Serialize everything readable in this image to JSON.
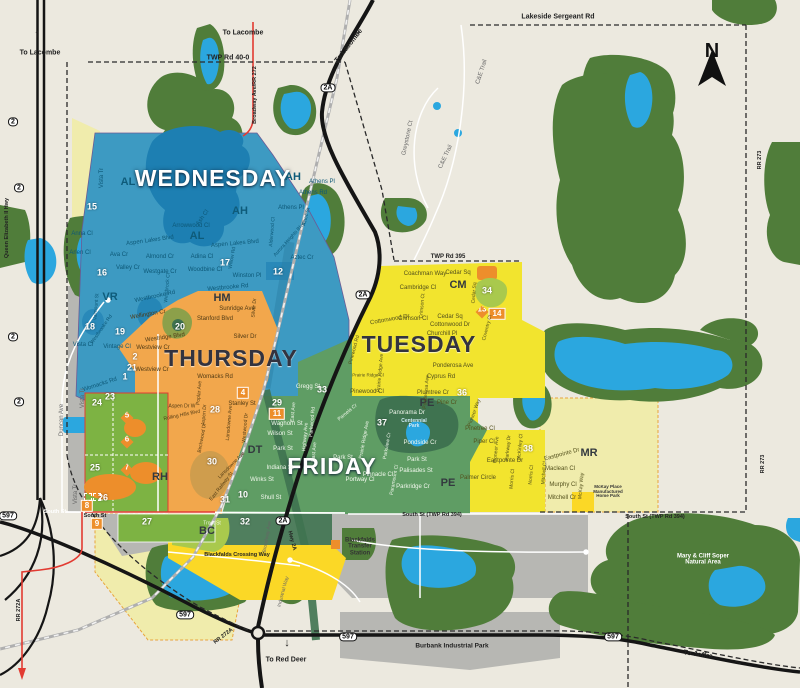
{
  "colors": {
    "background": "#ECE9DF",
    "forest": "#507D3A",
    "water": "#2BA7DF",
    "wednesday": "#3D9AC2",
    "thursday": "#F2A74C",
    "tuesday": "#F2E42E",
    "friday": "#5F9D64",
    "pale_zone": "#F0ECAC",
    "parcel_green": "#7DB343",
    "bc_gold": "#FBD826",
    "gray_zone": "#B7B7B3",
    "road": "#151515",
    "rail": "#AFAFAF",
    "route_red": "#E23B32",
    "marker_orange": "#ED8E2B",
    "dark_lake": "#1D7FB2",
    "park_olive": "#8CA04A",
    "dark_park": "#3F7350"
  },
  "compass": {
    "label": "N"
  },
  "days": [
    {
      "t": "WEDNESDAY",
      "x": 213,
      "y": 178,
      "c": "day-w",
      "n": "day-zone-label-wednesday"
    },
    {
      "t": "THURSDAY",
      "x": 231,
      "y": 358,
      "c": "day-d",
      "n": "day-zone-label-thursday"
    },
    {
      "t": "TUESDAY",
      "x": 419,
      "y": 344,
      "c": "day-d",
      "n": "day-zone-label-tuesday"
    },
    {
      "t": "FRIDAY",
      "x": 332,
      "y": 466,
      "c": "day-w",
      "n": "day-zone-label-friday"
    }
  ],
  "districts": [
    {
      "t": "AL",
      "x": 128,
      "y": 183,
      "c": "ac-b"
    },
    {
      "t": "AH",
      "x": 240,
      "y": 212,
      "c": "ac-b"
    },
    {
      "t": "AH",
      "x": 293,
      "y": 178,
      "c": "ac-b"
    },
    {
      "t": "AL",
      "x": 197,
      "y": 237,
      "c": "ac-b"
    },
    {
      "t": "VR",
      "x": 110,
      "y": 298,
      "c": "ac-b"
    },
    {
      "t": "HM",
      "x": 222,
      "y": 299,
      "c": "ac-d"
    },
    {
      "t": "CM",
      "x": 458,
      "y": 286,
      "c": "ac-d"
    },
    {
      "t": "PE",
      "x": 427,
      "y": 404,
      "c": "ac-d"
    },
    {
      "t": "PE",
      "x": 448,
      "y": 484,
      "c": "ac-d"
    },
    {
      "t": "DT",
      "x": 255,
      "y": 451,
      "c": "ac-d"
    },
    {
      "t": "RH",
      "x": 160,
      "y": 478,
      "c": "ac-d"
    },
    {
      "t": "BC",
      "x": 207,
      "y": 532,
      "c": "ac-d"
    },
    {
      "t": "MR",
      "x": 589,
      "y": 454,
      "c": "ac-d"
    }
  ],
  "zone_numbers": [
    {
      "t": "15",
      "x": 92,
      "y": 207
    },
    {
      "t": "16",
      "x": 102,
      "y": 273
    },
    {
      "t": "17",
      "x": 225,
      "y": 263
    },
    {
      "t": "12",
      "x": 278,
      "y": 272
    },
    {
      "t": "18",
      "x": 90,
      "y": 327
    },
    {
      "t": "19",
      "x": 120,
      "y": 332
    },
    {
      "t": "20",
      "x": 180,
      "y": 327
    },
    {
      "t": "2",
      "x": 135,
      "y": 357
    },
    {
      "t": "21",
      "x": 132,
      "y": 368
    },
    {
      "t": "1",
      "x": 125,
      "y": 377
    },
    {
      "t": "23",
      "x": 110,
      "y": 397
    },
    {
      "t": "24",
      "x": 97,
      "y": 403
    },
    {
      "t": "25",
      "x": 95,
      "y": 468
    },
    {
      "t": "26",
      "x": 103,
      "y": 498
    },
    {
      "t": "27",
      "x": 147,
      "y": 522
    },
    {
      "t": "28",
      "x": 215,
      "y": 410
    },
    {
      "t": "29",
      "x": 277,
      "y": 403
    },
    {
      "t": "30",
      "x": 212,
      "y": 462
    },
    {
      "t": "31",
      "x": 225,
      "y": 500
    },
    {
      "t": "32",
      "x": 245,
      "y": 522
    },
    {
      "t": "33",
      "x": 322,
      "y": 390
    },
    {
      "t": "10",
      "x": 243,
      "y": 495
    },
    {
      "t": "34",
      "x": 487,
      "y": 291
    },
    {
      "t": "36",
      "x": 462,
      "y": 393
    },
    {
      "t": "37",
      "x": 382,
      "y": 423
    },
    {
      "t": "38",
      "x": 528,
      "y": 449
    }
  ],
  "zone_badges": [
    {
      "t": "8",
      "x": 87,
      "y": 506
    },
    {
      "t": "9",
      "x": 97,
      "y": 524
    },
    {
      "t": "11",
      "x": 277,
      "y": 414
    },
    {
      "t": "4",
      "x": 243,
      "y": 393
    },
    {
      "t": "14",
      "x": 497,
      "y": 314
    }
  ],
  "zone_markers": [
    {
      "t": "5",
      "x": 127,
      "y": 418
    },
    {
      "t": "6",
      "x": 127,
      "y": 442
    },
    {
      "t": "7",
      "x": 127,
      "y": 470
    },
    {
      "t": "13",
      "x": 482,
      "y": 312
    }
  ],
  "highway_badges": [
    {
      "t": "2A",
      "x": 328,
      "y": 88
    },
    {
      "t": "2A",
      "x": 363,
      "y": 295
    },
    {
      "t": "2A",
      "x": 283,
      "y": 521
    },
    {
      "t": "597",
      "x": 8,
      "y": 516
    },
    {
      "t": "597",
      "x": 185,
      "y": 615
    },
    {
      "t": "597",
      "x": 348,
      "y": 637
    },
    {
      "t": "597",
      "x": 613,
      "y": 637
    },
    {
      "t": "2",
      "x": 13,
      "y": 122
    },
    {
      "t": "2",
      "x": 19,
      "y": 188
    },
    {
      "t": "2",
      "x": 13,
      "y": 337
    },
    {
      "t": "2",
      "x": 19,
      "y": 402
    }
  ],
  "road_labels": [
    {
      "t": "TWP Rd 40-0",
      "x": 228,
      "y": 58
    },
    {
      "t": "Lakeside Sergeant Rd",
      "x": 558,
      "y": 17
    },
    {
      "t": "Broadway Ave/RR 272",
      "x": 256,
      "y": 95,
      "r": -90,
      "s": 5.5
    },
    {
      "t": "RR 273",
      "x": 761,
      "y": 160,
      "r": -90,
      "s": 5.5
    },
    {
      "t": "RR 273",
      "x": 764,
      "y": 464,
      "r": -90,
      "s": 5.5
    },
    {
      "t": "TWP Rd 395",
      "x": 448,
      "y": 257,
      "s": 6
    },
    {
      "t": "Queen Elizabeth II Hwy",
      "x": 8,
      "y": 228,
      "r": -90,
      "s": 5.5
    },
    {
      "t": "South St",
      "x": 55,
      "y": 513,
      "c": "rd-w",
      "s": 5.5
    },
    {
      "t": "South St",
      "x": 95,
      "y": 517,
      "s": 5.5
    },
    {
      "t": "South St (TWP Rd 394)",
      "x": 432,
      "y": 516,
      "s": 5.5
    },
    {
      "t": "South St (TWP Rd 394)",
      "x": 655,
      "y": 518,
      "s": 5.5
    },
    {
      "t": "Hwy 2A",
      "x": 291,
      "y": 541,
      "r": 75,
      "s": 5.5
    },
    {
      "t": "RR 272A",
      "x": 224,
      "y": 637,
      "r": -38,
      "s": 5.5
    },
    {
      "t": "RR 272A",
      "x": 20,
      "y": 610,
      "r": -90,
      "s": 5.5
    },
    {
      "t": "Burbank Industrial Park",
      "x": 452,
      "y": 647,
      "s": 6.5
    },
    {
      "t": "Blackfalds Crossing Way",
      "x": 237,
      "y": 556,
      "s": 5.5
    }
  ],
  "direction_labels": [
    {
      "t": "To Lacombe",
      "x": 40,
      "y": 53
    },
    {
      "t": "To Lacombe",
      "x": 243,
      "y": 33
    },
    {
      "t": "To Lacombe",
      "x": 349,
      "y": 46,
      "r": -52
    },
    {
      "t": "To Red Deer",
      "x": 286,
      "y": 660
    },
    {
      "t": "To Joffre",
      "x": 698,
      "y": 655,
      "r": 8
    }
  ],
  "arrows": [
    {
      "t": "↑",
      "x": 37,
      "y": 35
    },
    {
      "t": "↓",
      "x": 287,
      "y": 644
    },
    {
      "t": "→",
      "x": 357,
      "y": 34,
      "r": -55
    },
    {
      "t": "→",
      "x": 738,
      "y": 662,
      "r": 25
    }
  ],
  "poi_labels": [
    {
      "t": "Mary & Cliff Soper\nNatural Area",
      "x": 703,
      "y": 560,
      "c": "poi-w",
      "w": 80
    },
    {
      "t": "Blackfalds\nTransfer\nStation",
      "x": 360,
      "y": 547,
      "w": 46
    },
    {
      "t": "Centennial\nPark",
      "x": 414,
      "y": 424,
      "c": "poi-b",
      "w": 44,
      "s": 5
    },
    {
      "t": "McKay Place\nManufactured\nHome Park",
      "x": 608,
      "y": 492,
      "s": 4.5,
      "w": 42
    }
  ],
  "street_labels": [
    {
      "t": "Vista Tr",
      "x": 102,
      "y": 178,
      "r": -90,
      "c": "st-b"
    },
    {
      "t": "Anna Cl",
      "x": 82,
      "y": 234,
      "c": "st-b"
    },
    {
      "t": "Arlen Cl",
      "x": 80,
      "y": 253,
      "c": "st-b"
    },
    {
      "t": "Ava Cr",
      "x": 119,
      "y": 255,
      "c": "st-b"
    },
    {
      "t": "Aspen Lakes Blvd",
      "x": 150,
      "y": 241,
      "r": -8,
      "c": "st-b"
    },
    {
      "t": "Aspen Lakes Blvd",
      "x": 235,
      "y": 244,
      "r": -5,
      "c": "st-b"
    },
    {
      "t": "Almond Cr",
      "x": 160,
      "y": 257,
      "c": "st-b"
    },
    {
      "t": "Valley Cr",
      "x": 128,
      "y": 268,
      "c": "st-b"
    },
    {
      "t": "Westgate Cr",
      "x": 160,
      "y": 272,
      "c": "st-b"
    },
    {
      "t": "Westbrock Cl",
      "x": 168,
      "y": 288,
      "r": -85,
      "c": "st-b",
      "s": 5
    },
    {
      "t": "Westbrooke Rd",
      "x": 155,
      "y": 297,
      "r": -12,
      "c": "st-b"
    },
    {
      "t": "Westbrooke Rd",
      "x": 228,
      "y": 288,
      "r": -5,
      "c": "st-b"
    },
    {
      "t": "Arrowwood Cl",
      "x": 191,
      "y": 226,
      "c": "st-b"
    },
    {
      "t": "Ash Cl",
      "x": 203,
      "y": 218,
      "r": -55,
      "c": "st-b"
    },
    {
      "t": "Adina Cl",
      "x": 202,
      "y": 257,
      "c": "st-b"
    },
    {
      "t": "Woodbine Cl",
      "x": 205,
      "y": 270,
      "c": "st-b"
    },
    {
      "t": "Winston Pl",
      "x": 247,
      "y": 276,
      "c": "st-b"
    },
    {
      "t": "Willow Rd",
      "x": 233,
      "y": 258,
      "r": -80,
      "c": "st-b",
      "s": 5
    },
    {
      "t": "Vista Cl",
      "x": 83,
      "y": 345,
      "c": "st-b"
    },
    {
      "t": "Valmount St",
      "x": 97,
      "y": 307,
      "r": -85,
      "c": "st-b",
      "s": 5
    },
    {
      "t": "Westbrooke Rd",
      "x": 102,
      "y": 330,
      "r": -55,
      "c": "st-b",
      "s": 5
    },
    {
      "t": "Vintage Cl",
      "x": 117,
      "y": 347,
      "c": "st-b"
    },
    {
      "t": "Womacks Rd",
      "x": 100,
      "y": 385,
      "r": -18,
      "c": "st-b"
    },
    {
      "t": "Athens Pl",
      "x": 322,
      "y": 182,
      "c": "st-b"
    },
    {
      "t": "Athens Rd",
      "x": 313,
      "y": 193,
      "c": "st-b"
    },
    {
      "t": "Athens Pl",
      "x": 291,
      "y": 208,
      "c": "st-b"
    },
    {
      "t": "Alderwood Cl",
      "x": 273,
      "y": 232,
      "r": -85,
      "c": "st-b",
      "s": 5
    },
    {
      "t": "Aurora Heights Blvd",
      "x": 290,
      "y": 240,
      "r": -48,
      "c": "st-b",
      "s": 5
    },
    {
      "t": "Aztec St",
      "x": 307,
      "y": 217,
      "r": -75,
      "c": "st-b",
      "s": 5
    },
    {
      "t": "Aztec Cr",
      "x": 302,
      "y": 258,
      "c": "st-b"
    },
    {
      "t": "Wellington Cr",
      "x": 148,
      "y": 315,
      "r": -10,
      "c": "st-o"
    },
    {
      "t": "Sunridge Ave",
      "x": 237,
      "y": 309,
      "c": "st-o"
    },
    {
      "t": "Stanford Blvd",
      "x": 215,
      "y": 319,
      "c": "st-o"
    },
    {
      "t": "Silver Dr",
      "x": 245,
      "y": 337,
      "c": "st-o"
    },
    {
      "t": "Silver Dr",
      "x": 255,
      "y": 308,
      "r": -85,
      "c": "st-o",
      "s": 5
    },
    {
      "t": "Westridge Blvd",
      "x": 165,
      "y": 338,
      "r": -8,
      "c": "st-o"
    },
    {
      "t": "Westview Cr",
      "x": 153,
      "y": 348,
      "c": "st-o"
    },
    {
      "t": "Westview Cr",
      "x": 152,
      "y": 370,
      "c": "st-o"
    },
    {
      "t": "Womacks Rd",
      "x": 215,
      "y": 377,
      "c": "st-o"
    },
    {
      "t": "Poplar Ave",
      "x": 200,
      "y": 393,
      "r": -85,
      "c": "st-o",
      "s": 5
    },
    {
      "t": "Aspen Dr W",
      "x": 182,
      "y": 407,
      "c": "st-o",
      "s": 5
    },
    {
      "t": "Aspen Dr",
      "x": 205,
      "y": 415,
      "r": -85,
      "c": "st-o",
      "s": 5
    },
    {
      "t": "Stanley St",
      "x": 242,
      "y": 404,
      "c": "st-o"
    },
    {
      "t": "Lansdowne Ave",
      "x": 230,
      "y": 423,
      "r": -85,
      "c": "st-o",
      "s": 5
    },
    {
      "t": "Westwood Dr",
      "x": 246,
      "y": 428,
      "r": -85,
      "c": "st-o",
      "s": 5
    },
    {
      "t": "Lansdowne Ave",
      "x": 232,
      "y": 466,
      "r": -45,
      "c": "st-o",
      "s": 5
    },
    {
      "t": "Rolling Hills Blvd",
      "x": 182,
      "y": 416,
      "r": -12,
      "c": "st-o",
      "s": 5
    },
    {
      "t": "Birchwood Dr",
      "x": 203,
      "y": 438,
      "r": -80,
      "c": "st-o",
      "s": 5
    },
    {
      "t": "East Railway St",
      "x": 222,
      "y": 487,
      "r": -52,
      "c": "st-o",
      "s": 5
    },
    {
      "t": "Gregg St",
      "x": 308,
      "y": 387,
      "c": "st-g"
    },
    {
      "t": "Waghorn St",
      "x": 287,
      "y": 424,
      "c": "st-g"
    },
    {
      "t": "Wilson St",
      "x": 280,
      "y": 434,
      "c": "st-g"
    },
    {
      "t": "Park St",
      "x": 283,
      "y": 449,
      "c": "st-g"
    },
    {
      "t": "Indiana St",
      "x": 280,
      "y": 468,
      "c": "st-g"
    },
    {
      "t": "Winks St",
      "x": 262,
      "y": 480,
      "c": "st-g"
    },
    {
      "t": "Shull St",
      "x": 271,
      "y": 498,
      "c": "st-g"
    },
    {
      "t": "East Ave",
      "x": 294,
      "y": 412,
      "r": -85,
      "c": "st-g",
      "s": 5
    },
    {
      "t": "Highway Ave",
      "x": 306,
      "y": 437,
      "r": -85,
      "c": "st-g",
      "s": 5
    },
    {
      "t": "East Ave",
      "x": 315,
      "y": 452,
      "r": -85,
      "c": "st-g",
      "s": 5
    },
    {
      "t": "Parkwood Rd",
      "x": 313,
      "y": 422,
      "r": -85,
      "c": "st-g",
      "s": 5
    },
    {
      "t": "Panorama Dr",
      "x": 407,
      "y": 413,
      "c": "st-g"
    },
    {
      "t": "Pamela Cr",
      "x": 348,
      "y": 413,
      "r": -40,
      "c": "st-g",
      "s": 5
    },
    {
      "t": "Prairie Ridge Ave",
      "x": 365,
      "y": 440,
      "r": -80,
      "c": "st-g",
      "s": 5
    },
    {
      "t": "Parkview Cr",
      "x": 388,
      "y": 446,
      "r": -80,
      "c": "st-g",
      "s": 5
    },
    {
      "t": "Pondside Cr",
      "x": 420,
      "y": 443,
      "c": "st-g"
    },
    {
      "t": "Park St",
      "x": 417,
      "y": 460,
      "c": "st-g"
    },
    {
      "t": "Palisades St",
      "x": 416,
      "y": 471,
      "c": "st-g"
    },
    {
      "t": "Parkridge Cr",
      "x": 413,
      "y": 487,
      "c": "st-g"
    },
    {
      "t": "Paramount Cl",
      "x": 395,
      "y": 480,
      "r": -80,
      "c": "st-g",
      "s": 5
    },
    {
      "t": "Pinnacle Cl",
      "x": 378,
      "y": 475,
      "c": "st-g"
    },
    {
      "t": "Portway Cl",
      "x": 360,
      "y": 480,
      "c": "st-g"
    },
    {
      "t": "Park St",
      "x": 343,
      "y": 458,
      "c": "st-g"
    },
    {
      "t": "Coachman Way",
      "x": 425,
      "y": 274,
      "c": "st-y"
    },
    {
      "t": "Cedar Sq",
      "x": 458,
      "y": 273,
      "c": "st-y"
    },
    {
      "t": "Cedar Sq",
      "x": 450,
      "y": 317,
      "c": "st-y"
    },
    {
      "t": "Cedar Sq",
      "x": 475,
      "y": 293,
      "r": -85,
      "c": "st-y",
      "s": 5
    },
    {
      "t": "Cambridge Cl",
      "x": 418,
      "y": 288,
      "c": "st-y"
    },
    {
      "t": "Crimson Ct",
      "x": 423,
      "y": 306,
      "r": -85,
      "c": "st-y",
      "s": 5
    },
    {
      "t": "Crimson Cl",
      "x": 413,
      "y": 319,
      "c": "st-y"
    },
    {
      "t": "Cottonwood Dr",
      "x": 390,
      "y": 320,
      "r": -10,
      "c": "st-y"
    },
    {
      "t": "Cottonwood Dr",
      "x": 450,
      "y": 325,
      "c": "st-y"
    },
    {
      "t": "Churchill Pl",
      "x": 442,
      "y": 334,
      "c": "st-y"
    },
    {
      "t": "Coventry Cl",
      "x": 488,
      "y": 328,
      "r": -75,
      "c": "st-y",
      "s": 5
    },
    {
      "t": "Ponderosa Ave",
      "x": 453,
      "y": 366,
      "c": "st-y"
    },
    {
      "t": "Ponderosa Ave",
      "x": 427,
      "y": 392,
      "r": -85,
      "c": "st-y",
      "s": 5
    },
    {
      "t": "Cyprus Rd",
      "x": 441,
      "y": 377,
      "c": "st-y"
    },
    {
      "t": "Plumtree Cr",
      "x": 433,
      "y": 393,
      "c": "st-y"
    },
    {
      "t": "Prairie Ridge Ave",
      "x": 381,
      "y": 373,
      "r": -85,
      "c": "st-y",
      "s": 5
    },
    {
      "t": "Prairie Ridge Cl",
      "x": 368,
      "y": 376,
      "c": "st-y",
      "s": 4.5
    },
    {
      "t": "Pinewood Cl",
      "x": 367,
      "y": 392,
      "c": "st-y"
    },
    {
      "t": "Pinewood Rd",
      "x": 355,
      "y": 350,
      "r": -75,
      "c": "st-y",
      "s": 5
    },
    {
      "t": "Pine Cr",
      "x": 447,
      "y": 403,
      "c": "st-y"
    },
    {
      "t": "Pioneer Way",
      "x": 475,
      "y": 413,
      "r": -70,
      "c": "st-y",
      "s": 5
    },
    {
      "t": "Pinetree Cl",
      "x": 480,
      "y": 429,
      "c": "st-y"
    },
    {
      "t": "Piper Cl",
      "x": 484,
      "y": 442,
      "c": "st-y"
    },
    {
      "t": "Pioneer Ave",
      "x": 497,
      "y": 450,
      "r": -85,
      "c": "st-y",
      "s": 5
    },
    {
      "t": "Parkway Dr",
      "x": 509,
      "y": 448,
      "r": -85,
      "c": "st-y",
      "s": 5
    },
    {
      "t": "Eastpointe Dr",
      "x": 505,
      "y": 461,
      "c": "st-y"
    },
    {
      "t": "Eastpointe Dr",
      "x": 562,
      "y": 455,
      "r": -15,
      "c": "st-y"
    },
    {
      "t": "Palmer Circle",
      "x": 478,
      "y": 478,
      "c": "st-y"
    },
    {
      "t": "McKinley Cl",
      "x": 521,
      "y": 447,
      "r": -85,
      "c": "st-y",
      "s": 5
    },
    {
      "t": "Morris Cl",
      "x": 513,
      "y": 479,
      "r": -85,
      "c": "st-y",
      "s": 5
    },
    {
      "t": "Norris Cl",
      "x": 532,
      "y": 475,
      "r": -85,
      "c": "st-y",
      "s": 5
    },
    {
      "t": "Mitchell Cl",
      "x": 545,
      "y": 473,
      "r": -85,
      "c": "st-y",
      "s": 5
    },
    {
      "t": "Maclean Cl",
      "x": 560,
      "y": 469,
      "c": "st-y"
    },
    {
      "t": "Murphy Cl",
      "x": 563,
      "y": 485,
      "c": "st-y"
    },
    {
      "t": "Mitchell Cr",
      "x": 562,
      "y": 498,
      "c": "st-y"
    },
    {
      "t": "McKay Way",
      "x": 582,
      "y": 486,
      "r": -85,
      "c": "st-y",
      "s": 5
    },
    {
      "t": "Greystone Ct",
      "x": 408,
      "y": 138,
      "r": -78,
      "c": "st-m"
    },
    {
      "t": "C&E Trail",
      "x": 482,
      "y": 72,
      "r": -72,
      "c": "st-m"
    },
    {
      "t": "C&E Trail",
      "x": 446,
      "y": 157,
      "r": -65,
      "c": "st-m"
    },
    {
      "t": "Duncan Ave",
      "x": 62,
      "y": 420,
      "r": -90,
      "c": "st-m"
    },
    {
      "t": "Vista Tr",
      "x": 83,
      "y": 398,
      "r": -90,
      "c": "st-m"
    },
    {
      "t": "Vista Tr",
      "x": 76,
      "y": 494,
      "r": -90,
      "c": "st-m"
    },
    {
      "t": "Broadway Ave",
      "x": 268,
      "y": 537,
      "r": -80,
      "c": "st-m",
      "s": 5
    },
    {
      "t": "Industrial Way",
      "x": 284,
      "y": 592,
      "r": -75,
      "c": "st-m",
      "s": 5
    },
    {
      "t": "Trout St",
      "x": 212,
      "y": 524,
      "c": "st-g",
      "s": 5
    }
  ]
}
